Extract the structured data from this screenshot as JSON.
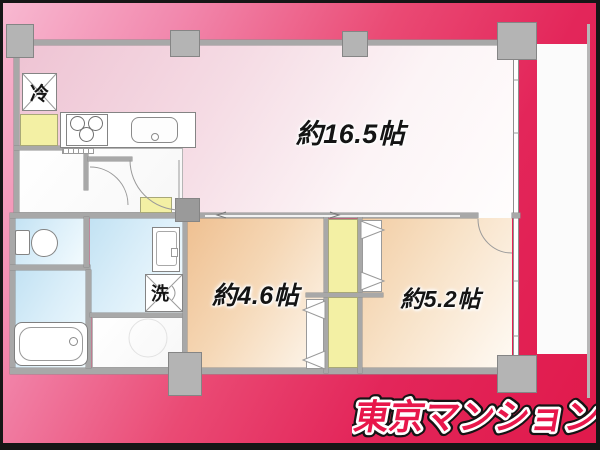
{
  "branding": {
    "logo_text": "東京マンション",
    "logo_color": "#e8174b"
  },
  "floorplan": {
    "rooms": [
      {
        "id": "ldk",
        "label": "約16.5帖"
      },
      {
        "id": "bedroom-a",
        "label": "約4.6帖"
      },
      {
        "id": "bedroom-b",
        "label": "約5.2帖"
      }
    ],
    "fixtures": [
      {
        "id": "refrigerator",
        "label": "冷"
      },
      {
        "id": "washing-machine",
        "label": "洗"
      }
    ]
  },
  "colors": {
    "background_top_left": "#f8bad2",
    "background_bottom_right": "#e0194b",
    "ldk_floor": "#eec3d3",
    "bedroom_a_floor": "#efc091",
    "bedroom_b_floor": "#f2cda4",
    "wet_area_floor": "#c2e2f3",
    "closet_fill": "#f3f0a4",
    "wall": "#a8a8a8",
    "pillar": "#b4b4b4",
    "logo_fill": "#e8174b",
    "frame": "#161616"
  }
}
